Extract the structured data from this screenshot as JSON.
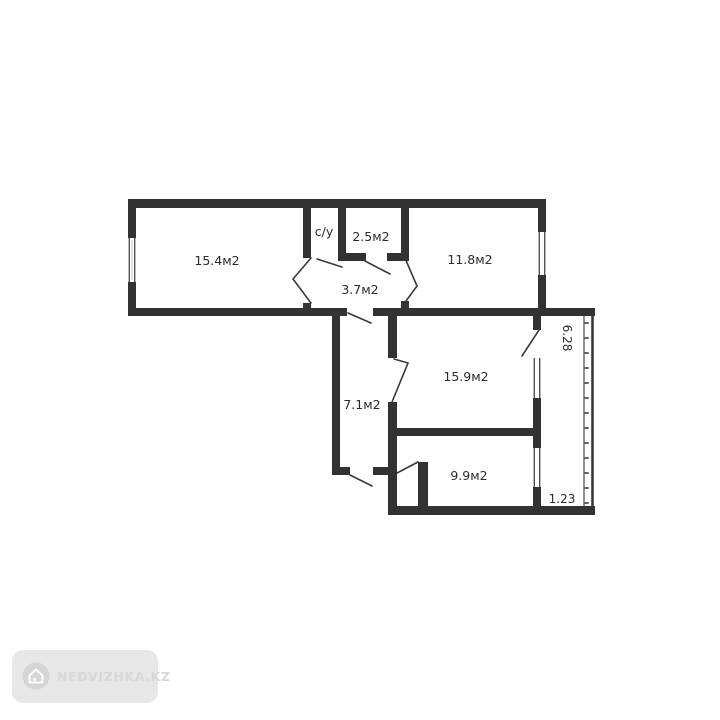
{
  "floor_plan": {
    "wall_color": "#323134",
    "rooms": [
      {
        "id": "room-15-4",
        "label": "15.4м2"
      },
      {
        "id": "bathroom",
        "label": "с/у"
      },
      {
        "id": "room-2-5",
        "label": "2.5м2"
      },
      {
        "id": "hall-3-7",
        "label": "3.7м2"
      },
      {
        "id": "room-11-8",
        "label": "11.8м2"
      },
      {
        "id": "room-15-9",
        "label": "15.9м2"
      },
      {
        "id": "corridor-7-1",
        "label": "7.1м2"
      },
      {
        "id": "room-9-9",
        "label": "9.9м2"
      }
    ],
    "dimensions": [
      {
        "id": "balcony-length",
        "label": "6.28"
      },
      {
        "id": "balcony-width",
        "label": "1.23"
      }
    ]
  },
  "watermark": {
    "label": "NEDVIZHKA.KZ",
    "icon": "house-icon",
    "badge_color": "#e8e7e5",
    "icon_color": "#d6d5d2",
    "text_color": "#d9d8d5"
  }
}
